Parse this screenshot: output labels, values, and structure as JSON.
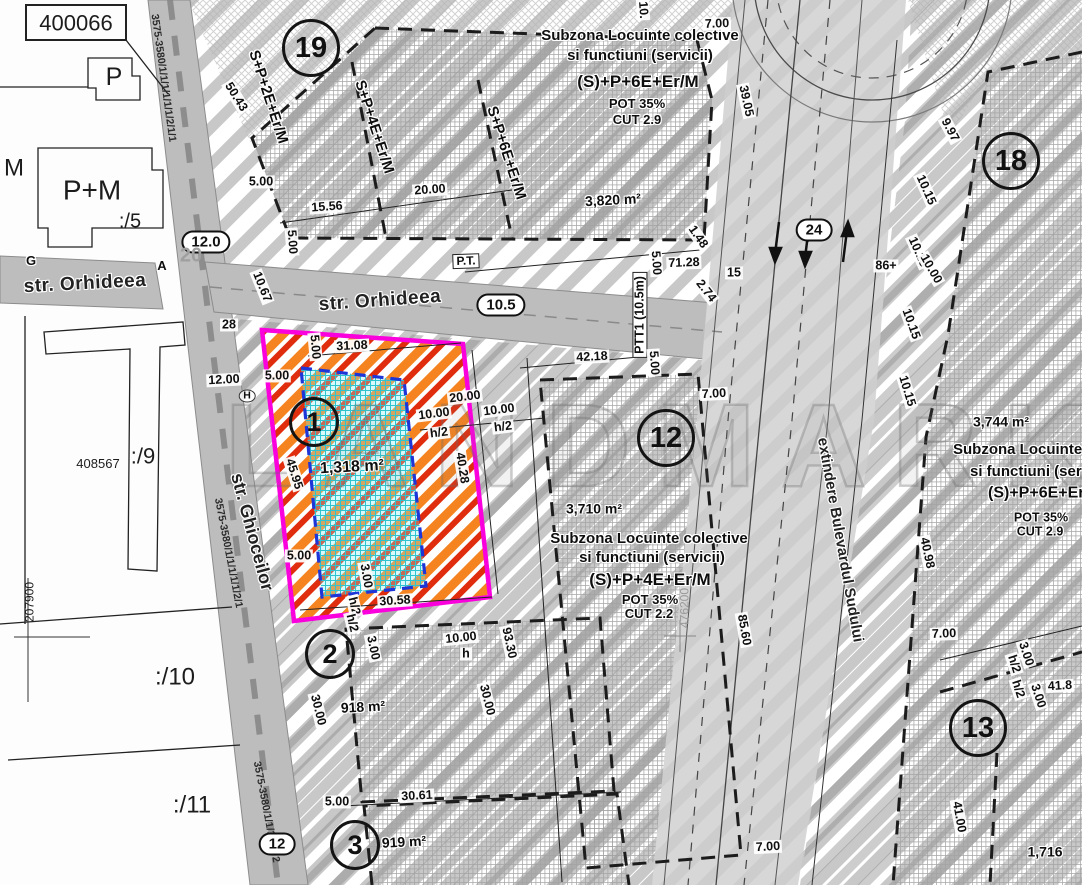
{
  "map": {
    "watermark": "LANDMARK",
    "streets": {
      "orhideea": "str. Orhideea",
      "ghioceilor": "str. Ghioceilor",
      "bulevard": "extindere Bulevardul Sudului"
    },
    "road_codes": {
      "top": "3575-3580/1/1/1/1/1/1/2/1/1",
      "mid": "3575-3580/1/1/1/1/1/2/1",
      "bot": "3575-3580/1/1/1/1/1/2"
    },
    "road_widths": {
      "a": "12.0",
      "b": "10.5",
      "c": "24",
      "d": "12"
    },
    "zone_circles": [
      "19",
      "18",
      "12",
      "13",
      "1",
      "2",
      "3"
    ],
    "letters": {
      "g": "G",
      "a": "A",
      "h": "H",
      "seg": "20"
    },
    "pt_box": "P.T.",
    "ptt1": "PTT1 (10.5m)",
    "coords": {
      "y": "207900",
      "x": "476200"
    },
    "parcels": {
      "n400066": "400066",
      "p": "P",
      "pm": "P+M",
      "s5": ":/5",
      "m": "M",
      "n408567": "408567",
      "s9": ":/9",
      "s10": ":/10",
      "s11": ":/11"
    },
    "areas": {
      "z19": "3,820 m²",
      "z12": "3,710 m²",
      "z18": "3,744 m²",
      "p1": "1,318 m²",
      "p918": "918 m²",
      "p919": "919 m²",
      "p1716": "1,716"
    },
    "zone19_block": {
      "t1": "Subzona Locuinte colective",
      "t2": "si functiuni (servicii)",
      "regime": "(S)+P+6E+Er/M",
      "pot": "POT 35%",
      "cut": "CUT 2.9"
    },
    "zone12_block": {
      "t1": "Subzona Locuinte colective",
      "t2": "si functiuni (servicii)",
      "regime": "(S)+P+4E+Er/M",
      "pot": "POT 35%",
      "cut": "CUT 2.2"
    },
    "zone18_block": {
      "t1": "Subzona Locuinte",
      "t2": "si functiuni (ser",
      "regime": "(S)+P+6E+Er",
      "pot": "POT 35%",
      "cut": "CUT 2.9"
    },
    "regimes": [
      "S+P+2E+Er/M",
      "S+P+4E+Er/M",
      "S+P+6E+Er/M"
    ],
    "colors": {
      "highlight_outline": "#fa00dd",
      "stripe_orange": "#f5831f",
      "stripe_red": "#df2d0d",
      "inner_grid_cyan": "#2fc4cf",
      "inner_border_blue": "#1e35d8",
      "hatch_gray": "#c8c8c8"
    },
    "dims": [
      "50.43",
      "5.00",
      "15.56",
      "20.00",
      "5.00",
      "10.67",
      "71.28",
      "7.00",
      "39.05",
      "1.48",
      "2.74",
      "15",
      "5.00",
      "42.18",
      "5.00",
      "10.",
      "31.08",
      "5.00",
      "5.00",
      "45.95",
      "5.00",
      "3.00",
      "30.58",
      "h/2",
      "h/2",
      "40.28",
      "20.00",
      "10.00",
      "10.00",
      "h/2",
      "h/2",
      "93.30",
      "30.00",
      "3.00",
      "10.00",
      "h",
      "30.00",
      "5.00",
      "30.61",
      "85.60",
      "7.00",
      "7.00",
      "7.00",
      "9.97",
      "10.15",
      "10.15",
      "10.00",
      "86+",
      "10.15",
      "10.15",
      "40.98",
      "41.00",
      "41.8",
      "3.00",
      "h/2",
      "h/2",
      "3.00",
      "12.00",
      "28"
    ]
  }
}
